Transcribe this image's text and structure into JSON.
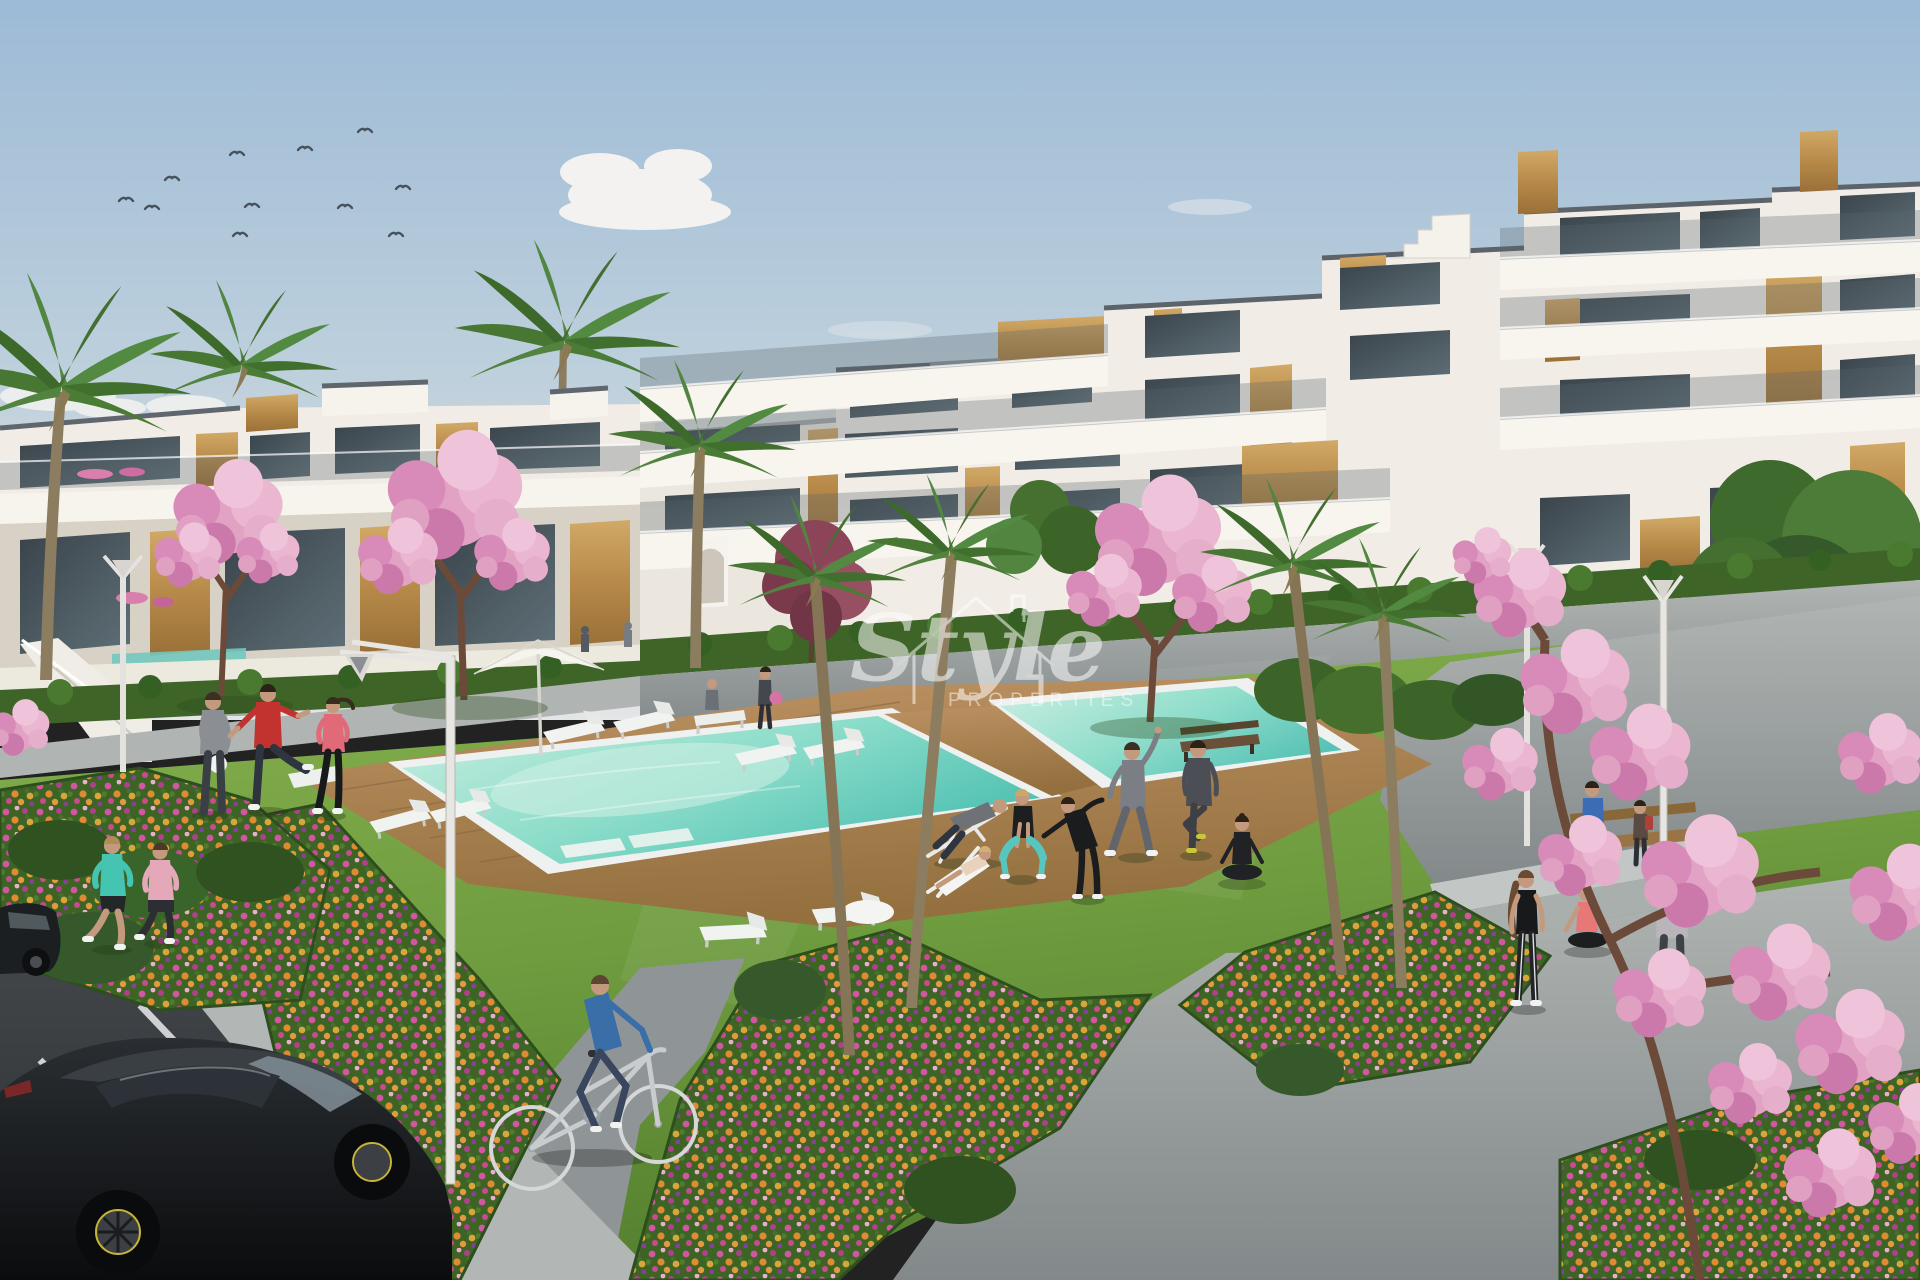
{
  "scene": {
    "type": "3d-architectural-visualisation",
    "subject": "Modern white apartment complex with communal garden, swimming pool, parking and people exercising",
    "watermark": {
      "script": "Style",
      "caps": "PROPERTIES"
    },
    "palette": {
      "sky_top": "#9dbad6",
      "sky_horizon": "#e3e5e6",
      "building_white": "#f2eee7",
      "wood_panel": "#c59a5d",
      "window_glass": "#3c454c",
      "roof_trim": "#5d646b",
      "grass": "#76a344",
      "hedge": "#3d6126",
      "pool_water": "#7fd8c8",
      "deck_wood": "#b0854f",
      "path_concrete": "#a6abaa",
      "asphalt": "#3e4144",
      "flower_pink": "#d157a2",
      "flower_orange": "#e08a34",
      "blossom_pink": "#e3a4c3",
      "car_black": "#17191b"
    },
    "inventory": {
      "birds": 11,
      "people": 20,
      "cars": 2,
      "bicycles": 1,
      "palm_trees": 8,
      "blossom_trees": 5,
      "street_lamps": 4,
      "sun_loungers": 9,
      "parasols": 1,
      "benches": 3,
      "pools": 2
    }
  }
}
